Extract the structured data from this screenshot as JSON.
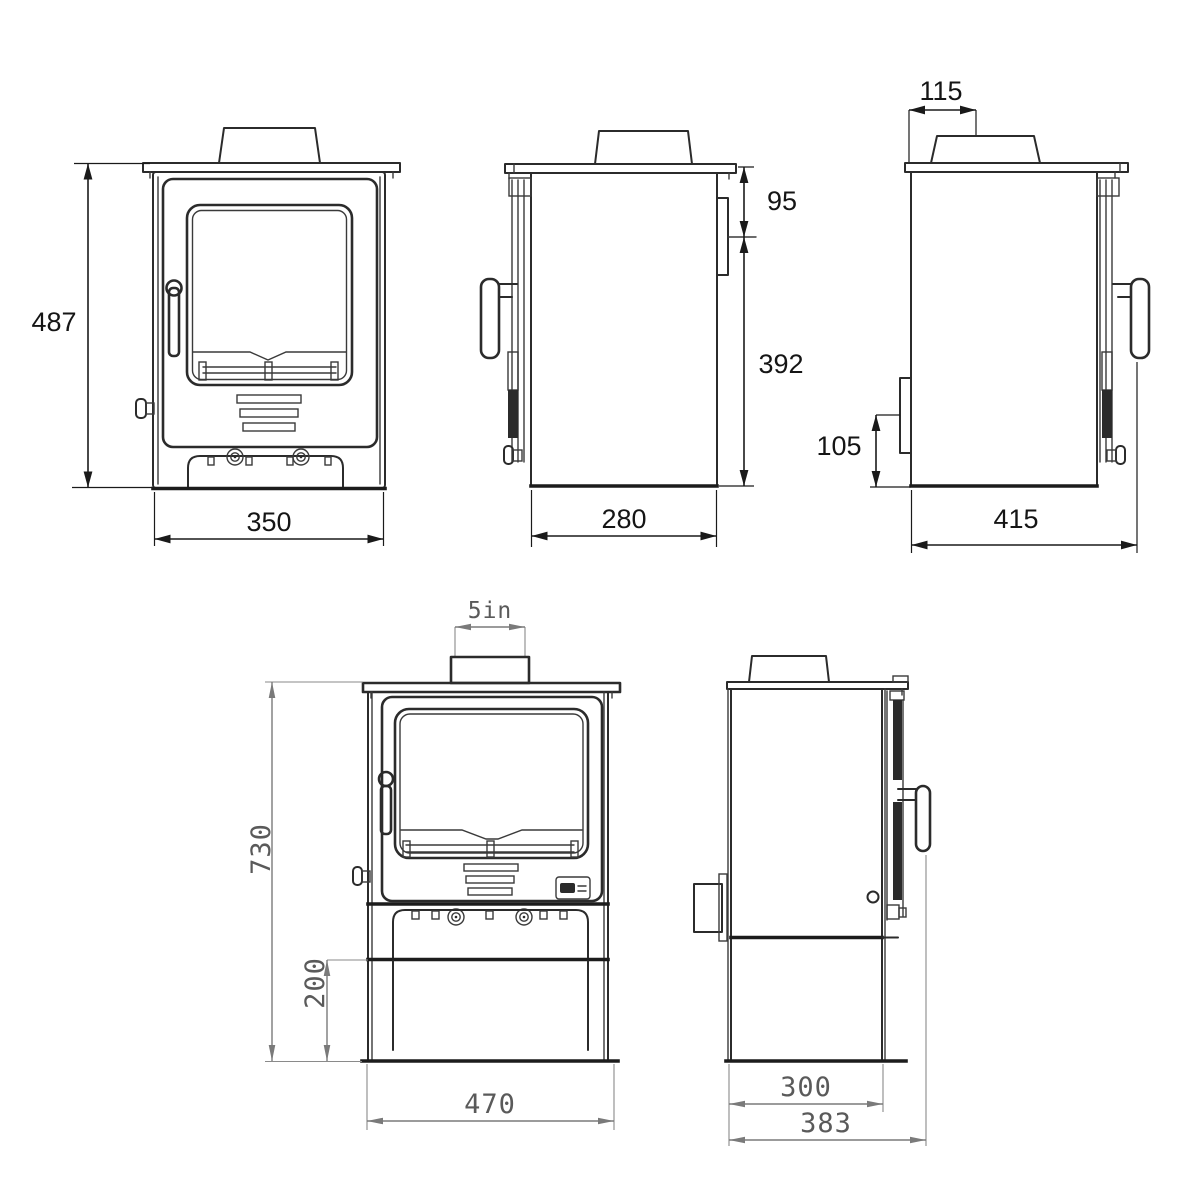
{
  "dims": {
    "front_small": {
      "height": "487",
      "width": "350"
    },
    "side_small": {
      "flue_offset": "95",
      "flue_height": "392",
      "depth": "280"
    },
    "side_rear": {
      "flue_center": "115",
      "inlet_height": "105",
      "overall_depth": "415"
    },
    "front_store": {
      "flue": "5in",
      "height": "730",
      "store_height": "200",
      "width": "470"
    },
    "side_store": {
      "depth": "300",
      "overall_depth": "383"
    }
  }
}
